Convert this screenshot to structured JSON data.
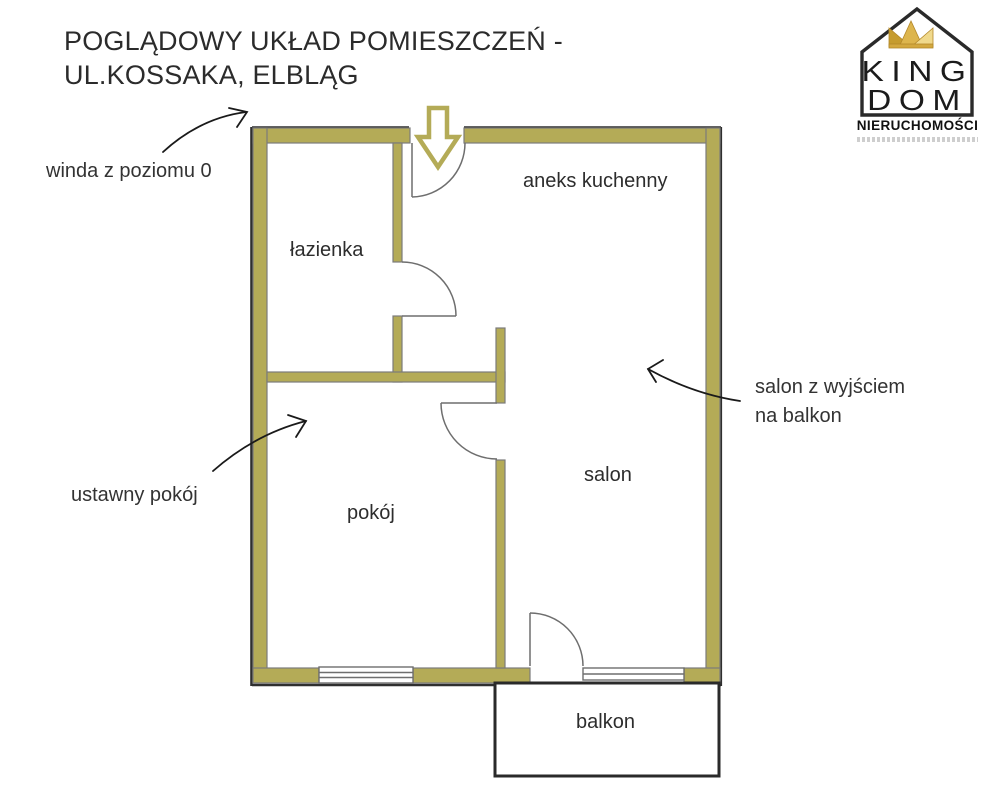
{
  "page": {
    "background": "#ffffff"
  },
  "title": {
    "line1": "POGLĄDOWY UKŁAD POMIESZCZEŃ -",
    "line2": "UL.KOSSAKA, ELBLĄG"
  },
  "logo": {
    "brand_line1": "KING",
    "brand_line2": "DOM",
    "tagline": "NIERUCHOMOŚCI",
    "colors": {
      "outline": "#2a2a2a",
      "crown_dark": "#c69c2f",
      "crown_mid": "#ddb54d",
      "crown_light": "#f0d98c"
    }
  },
  "floor_plan": {
    "colors": {
      "wall_fill": "#b4ab57",
      "wall_edge": "#7b7b7b",
      "outer_edge": "#2f2f2f",
      "door_stroke": "#6e6e6e",
      "annotation_arrow": "#1a1a1a",
      "entrance_arrow_outline": "#b4ab57"
    },
    "rooms": [
      {
        "name": "łazienka"
      },
      {
        "name": "aneks kuchenny"
      },
      {
        "name": "pokój"
      },
      {
        "name": "salon"
      },
      {
        "name": "balkon"
      }
    ],
    "annotations": [
      {
        "text": "winda z poziomu 0"
      },
      {
        "text": "ustawny pokój"
      },
      {
        "text_line1": "salon z wyjściem",
        "text_line2": "na balkon"
      }
    ],
    "entrance_arrow": "entrance-direction-down"
  }
}
